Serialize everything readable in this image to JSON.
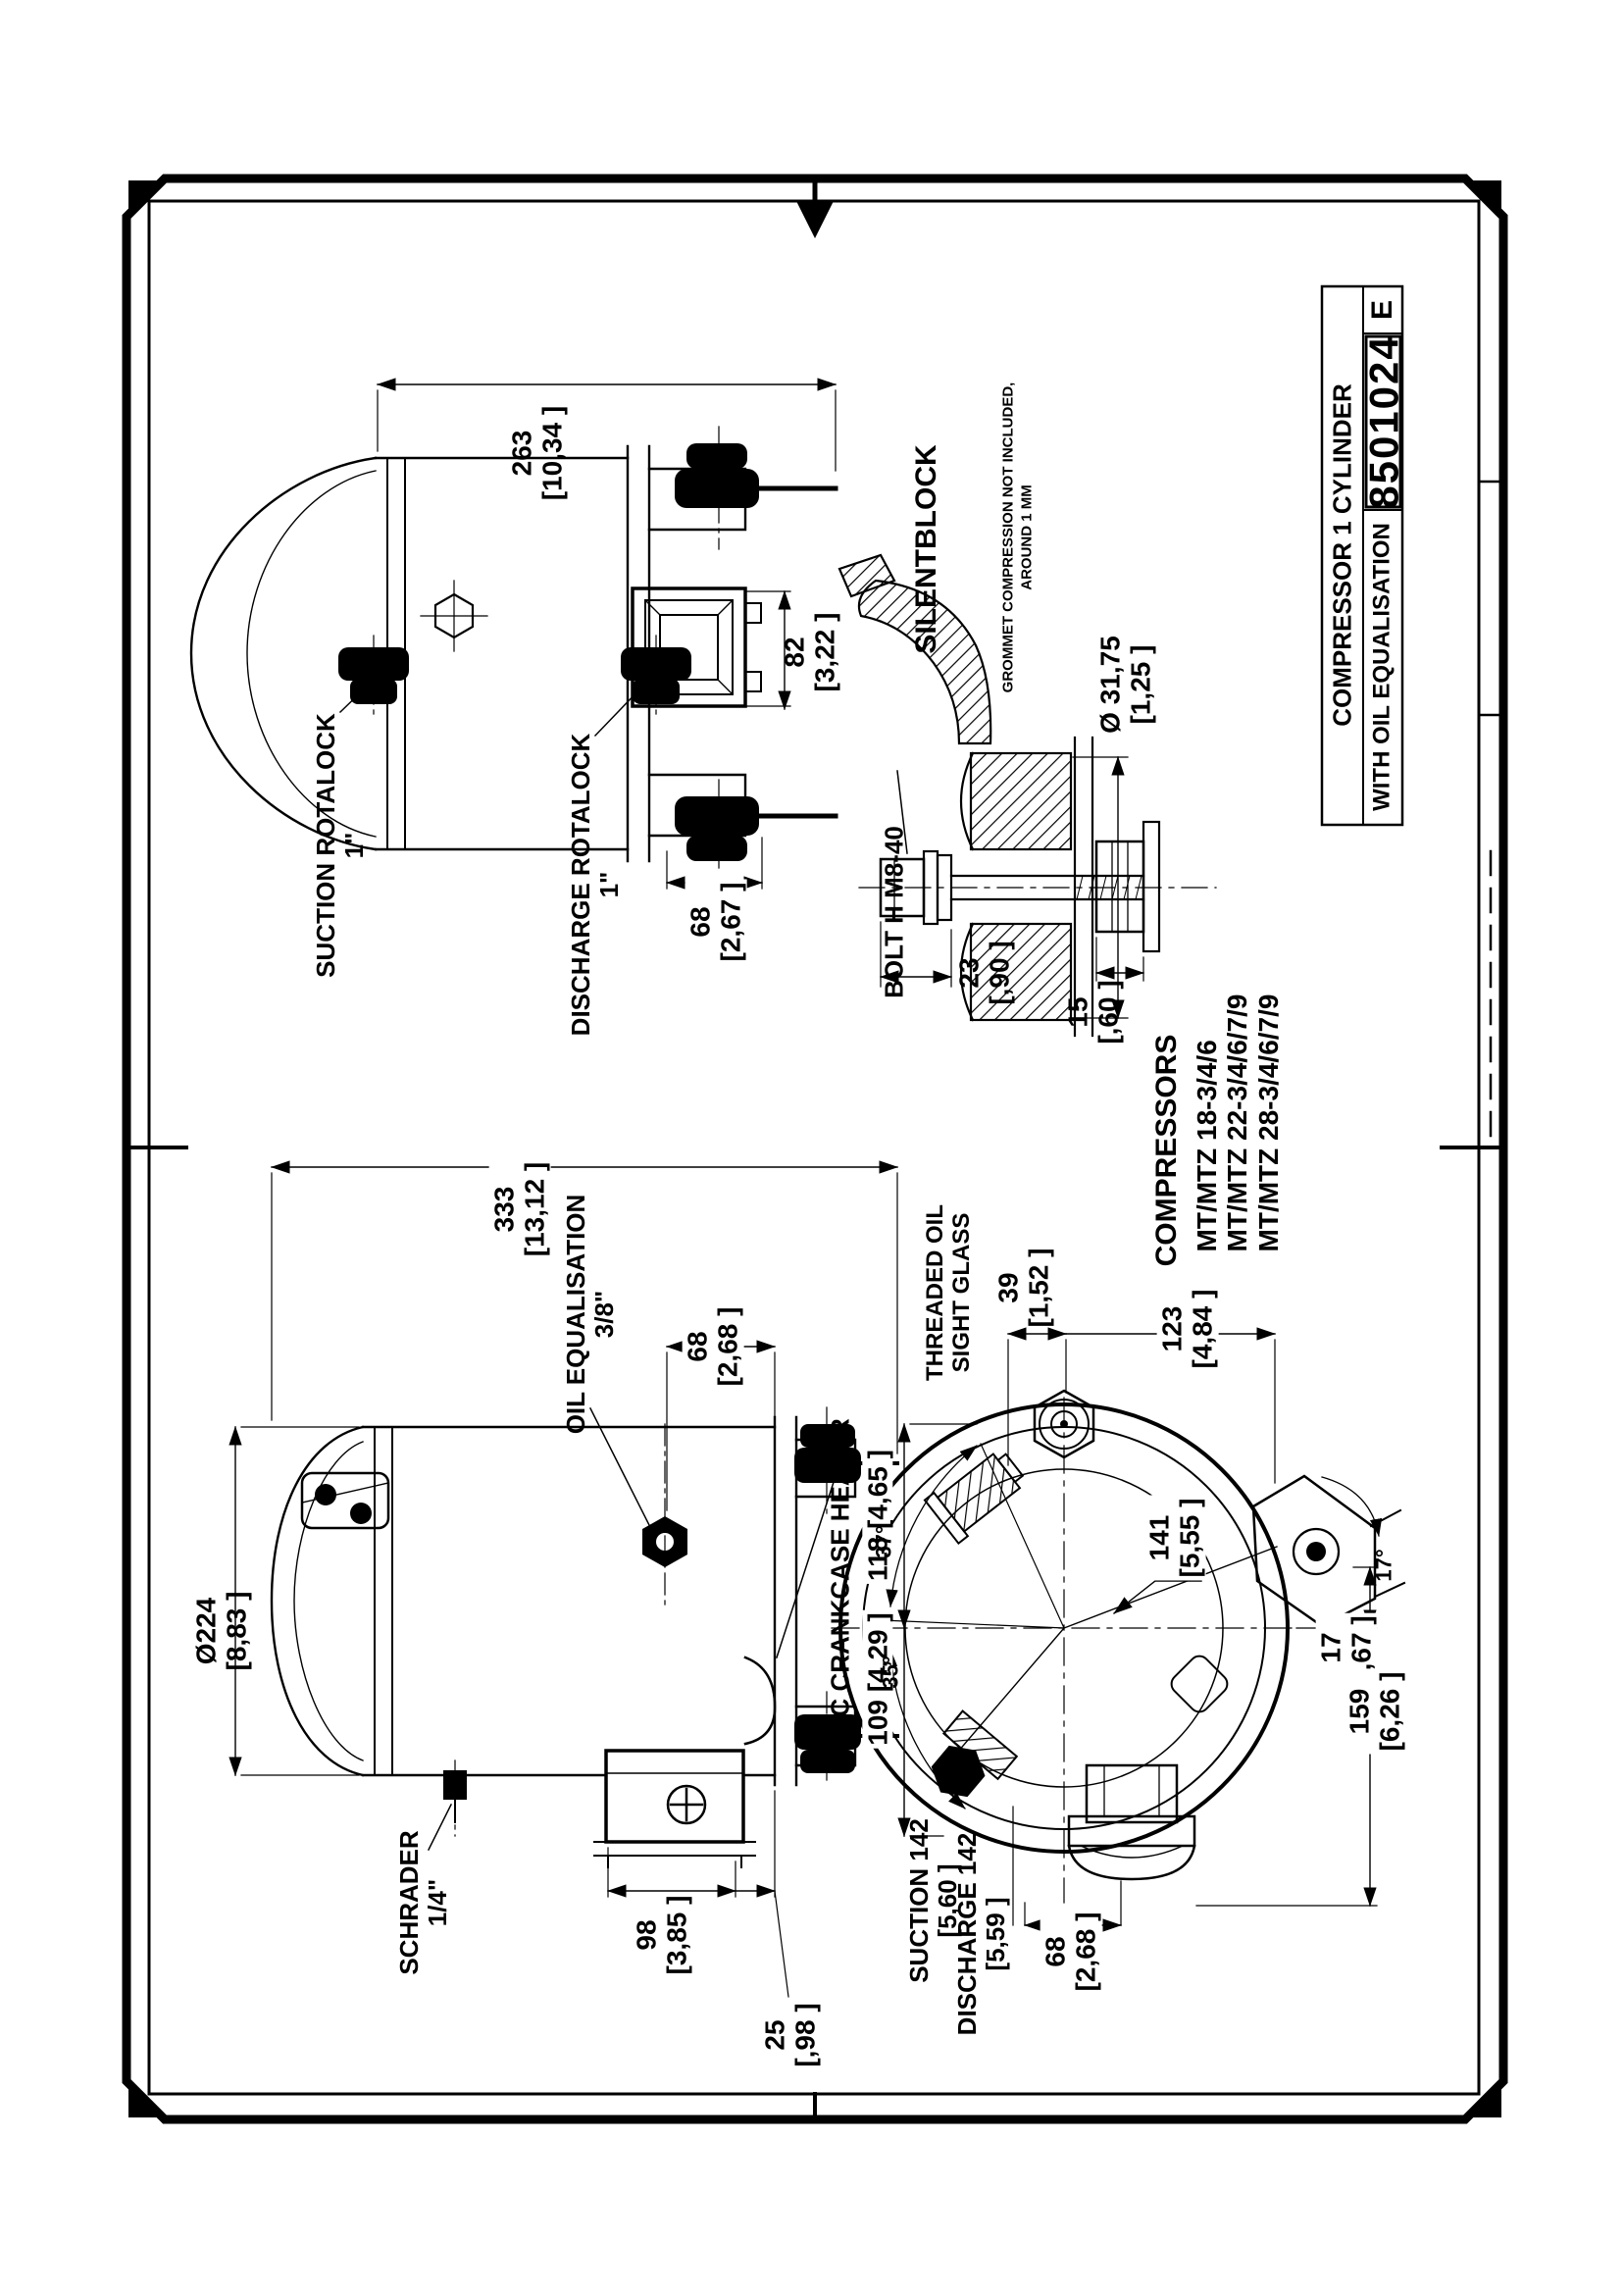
{
  "page": {
    "background": "#ffffff",
    "line_color": "#000000"
  },
  "title_block": {
    "title_line1": "COMPRESSOR 1 CYLINDER",
    "title_line2": "WITH OIL EQUALISATION",
    "drawing_number": "8501024",
    "revision": "E"
  },
  "side_view": {
    "dim_overall_mm": "263",
    "dim_overall_in": "[10,34 ]",
    "dim_ports_mm": "82",
    "dim_ports_in": "[3,22 ]",
    "dim_foot_mm": "68",
    "dim_foot_in": "[2,67 ]",
    "suction_label": "SUCTION ROTALOCK",
    "suction_size": "1\"",
    "discharge_label": "DISCHARGE ROTALOCK",
    "discharge_size": "1\""
  },
  "silentblock_view": {
    "title": "SILENTBLOCK",
    "note_line1": "GROMMET COMPRESSION NOT INCLUDED,",
    "note_line2": "AROUND 1 MM",
    "bolt_label": "BOLT H M8-40",
    "dim_grommet_dia_mm": "Ø 31,75",
    "dim_grommet_dia_in": "[1,25 ]",
    "dim_head_mm": "23",
    "dim_head_in": "[,90 ]",
    "dim_nut_mm": "15",
    "dim_nut_in": "[,60 ]"
  },
  "compressors_list": {
    "heading": "COMPRESSORS",
    "models": [
      "MT/MTZ 18-3/4/6",
      "MT/MTZ 22-3/4/6/7/9",
      "MT/MTZ 28-3/4/6/7/9"
    ]
  },
  "front_view": {
    "dim_height_mm": "333",
    "dim_height_in": "[13,12 ]",
    "dim_shell_dia_mm": "Ø224",
    "dim_shell_dia_in": "[8,83 ]",
    "oil_eq_label": "OIL EQUALISATION",
    "oil_eq_size": "3/8\"",
    "dim_oileq_mm": "68",
    "dim_oileq_in": "[2,68 ]",
    "heater_label": "PTC CRANKCASE HEATER",
    "schrader_label": "SCHRADER",
    "schrader_size": "1/4\"",
    "dim_box_mm": "98",
    "dim_box_in": "[3,85 ]",
    "dim_edge_mm": "25",
    "dim_edge_in": "[,98 ]"
  },
  "top_view": {
    "sight_glass_line1": "THREADED OIL",
    "sight_glass_line2": "SIGHT GLASS",
    "dim_sight_mm": "39",
    "dim_sight_in": "[1,52 ]",
    "dim_lug_mm": "123",
    "dim_lug_in": "[4,84 ]",
    "dim_radius_mm": "141",
    "dim_radius_in": "[5,55 ]",
    "dim_118": "118 [4,65 ]",
    "dim_109": "109 [4,29 ]",
    "angle_top": "37°",
    "angle_bottom": "35°",
    "angle_lug": "17°",
    "dim_lugoff_mm": "17",
    "dim_lugoff_in": "[,67 ]",
    "dim_discharge_mm": "159",
    "dim_discharge_in": "[6,26 ]",
    "dim_stub_mm": "68",
    "dim_stub_in": "[2,68 ]",
    "suction_port_label": "SUCTION 142",
    "suction_port_in": "[5,60 ]",
    "discharge_port_label": "DISCHARGE 142",
    "discharge_port_in": "[5,59 ]"
  }
}
